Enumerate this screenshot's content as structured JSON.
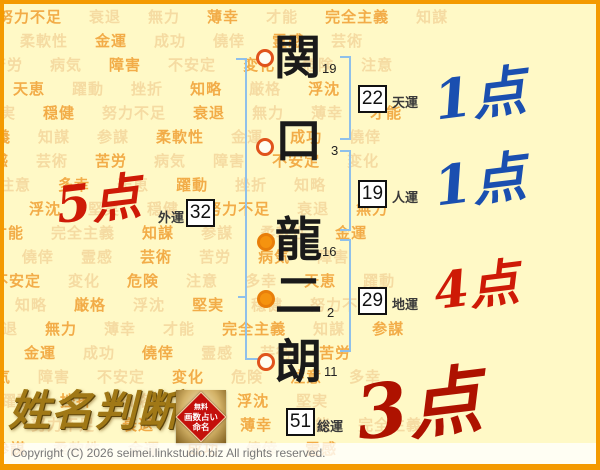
{
  "background": {
    "words": [
      "努力不足",
      "衰退",
      "無力",
      "薄幸",
      "才能",
      "完全主義",
      "知謀",
      "参謀",
      "柔軟性",
      "金運",
      "成功",
      "僥倖",
      "霊感",
      "芸術",
      "苦労",
      "病気",
      "障害",
      "不安定",
      "変化",
      "危険",
      "注意",
      "多幸",
      "天恵",
      "躍動",
      "挫折",
      "知略",
      "厳格",
      "浮沈",
      "堅実",
      "穏健"
    ]
  },
  "chart": {
    "characters": [
      {
        "char": "関",
        "strokes": "19",
        "circle": "open"
      },
      {
        "char": "口",
        "strokes": "3",
        "circle": "open"
      },
      {
        "char": "龍",
        "strokes": "16",
        "circle": "filled"
      },
      {
        "char": "二",
        "strokes": "2",
        "circle": "filled"
      },
      {
        "char": "朗",
        "strokes": "11",
        "circle": "open"
      }
    ],
    "fortunes": [
      {
        "key": "tenun",
        "value": "22",
        "label": "天運",
        "score": "1点"
      },
      {
        "key": "jinun",
        "value": "19",
        "label": "人運",
        "score": "1点"
      },
      {
        "key": "gaiun",
        "value": "32",
        "label": "外運",
        "score": "5点"
      },
      {
        "key": "chiun",
        "value": "29",
        "label": "地運",
        "score": "4点"
      },
      {
        "key": "soun",
        "value": "51",
        "label": "総運",
        "score": "3点"
      }
    ]
  },
  "logo": {
    "title": "姓名判断",
    "seal": {
      "line1": "無料",
      "line2": "画数占い",
      "line3": "命名"
    }
  },
  "footer": {
    "copyright": "Copyright (C) 2026 seimei.linkstudio.biz All rights reserved."
  },
  "colors": {
    "border_orange": "#F49A00",
    "background_yellow": "#FFF9C6",
    "bracket_blue": "#8FC0EA",
    "score_blue": "#1A4FB0",
    "score_red": "#CE1A06",
    "score_darkred": "#AE1200",
    "circle_ring_orange": "#E0531C",
    "circle_fill_orange": "#F5930F"
  }
}
